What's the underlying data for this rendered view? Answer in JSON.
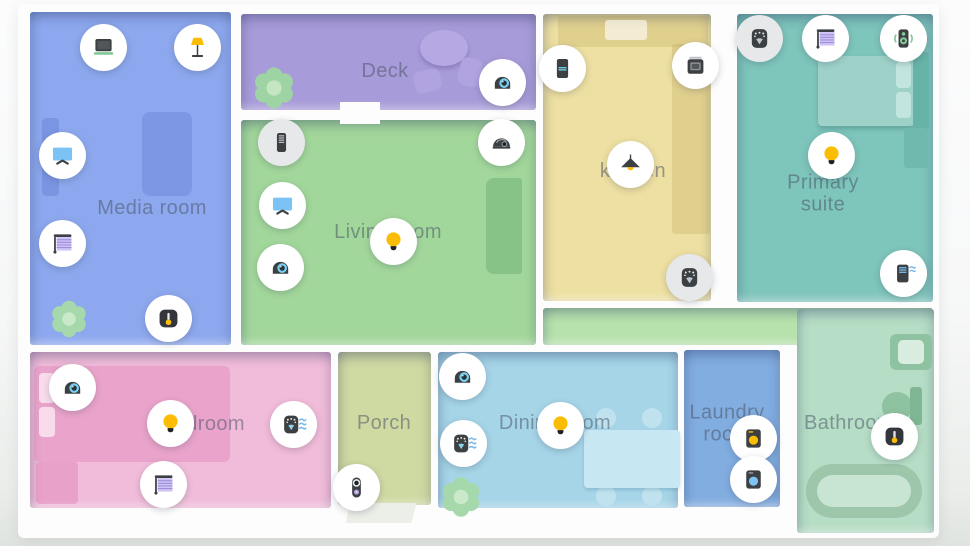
{
  "rooms": [
    {
      "id": "media-room",
      "label": "Media room",
      "color": "#8da8ee",
      "rect": {
        "x": 30,
        "y": 12,
        "w": 201,
        "h": 333
      },
      "label_pos": {
        "x": 152,
        "y": 208
      },
      "wrap": false
    },
    {
      "id": "deck",
      "label": "Deck",
      "color": "#a89bd9",
      "rect": {
        "x": 241,
        "y": 14,
        "w": 295,
        "h": 96
      },
      "label_pos": {
        "x": 385,
        "y": 71
      },
      "wrap": false
    },
    {
      "id": "living-room",
      "label": "Living room",
      "color": "#a2d79b",
      "rect": {
        "x": 241,
        "y": 120,
        "w": 295,
        "h": 225
      },
      "label_pos": {
        "x": 388,
        "y": 232
      },
      "wrap": false
    },
    {
      "id": "kitchen",
      "label": "kitchen",
      "color": "#eee0a2",
      "rect": {
        "x": 543,
        "y": 14,
        "w": 168,
        "h": 287
      },
      "label_pos": {
        "x": 633,
        "y": 171
      },
      "wrap": false
    },
    {
      "id": "primary-suite",
      "label": "Primary suite",
      "color": "#7ec5bb",
      "rect": {
        "x": 737,
        "y": 14,
        "w": 196,
        "h": 288
      },
      "label_pos": {
        "x": 823,
        "y": 194
      },
      "wrap": true
    },
    {
      "id": "hallway",
      "label": "",
      "color": "#b7e2ad",
      "rect": {
        "x": 543,
        "y": 308,
        "w": 390,
        "h": 37
      },
      "label_pos": {
        "x": 0,
        "y": 0
      },
      "wrap": false
    },
    {
      "id": "bedroom",
      "label": "Bedroom",
      "color": "#f1bcd9",
      "rect": {
        "x": 30,
        "y": 352,
        "w": 301,
        "h": 156
      },
      "label_pos": {
        "x": 203,
        "y": 424
      },
      "wrap": false
    },
    {
      "id": "porch",
      "label": "Porch",
      "color": "#cfd9a2",
      "rect": {
        "x": 338,
        "y": 352,
        "w": 93,
        "h": 153
      },
      "label_pos": {
        "x": 384,
        "y": 423
      },
      "wrap": false
    },
    {
      "id": "dining-room",
      "label": "Dining room",
      "color": "#a6d5e8",
      "rect": {
        "x": 438,
        "y": 352,
        "w": 240,
        "h": 156
      },
      "label_pos": {
        "x": 555,
        "y": 423
      },
      "wrap": false
    },
    {
      "id": "laundry-room",
      "label": "Laundry room",
      "color": "#82ade0",
      "rect": {
        "x": 684,
        "y": 350,
        "w": 96,
        "h": 157
      },
      "label_pos": {
        "x": 727,
        "y": 424
      },
      "wrap": true
    },
    {
      "id": "bathroom",
      "label": "Bathroom",
      "color": "#b6ddc5",
      "rect": {
        "x": 797,
        "y": 309,
        "w": 137,
        "h": 224
      },
      "label_pos": {
        "x": 849,
        "y": 423
      },
      "wrap": false
    }
  ],
  "devices": [
    {
      "room": "Media room",
      "icon": "laptop-icon",
      "x": 103,
      "y": 47,
      "muted": false
    },
    {
      "room": "Media room",
      "icon": "floor-lamp-icon",
      "x": 197,
      "y": 47,
      "muted": false
    },
    {
      "room": "Media room",
      "icon": "tv-icon",
      "x": 62,
      "y": 155,
      "muted": false
    },
    {
      "room": "Media room",
      "icon": "blinds-icon",
      "x": 62,
      "y": 243,
      "muted": false
    },
    {
      "room": "Media room",
      "icon": "thermostat-icon",
      "x": 168,
      "y": 318,
      "muted": false
    },
    {
      "room": "Deck",
      "icon": "camera-icon",
      "x": 502,
      "y": 82,
      "muted": false
    },
    {
      "room": "Living room",
      "icon": "speaker-tower-icon",
      "x": 281,
      "y": 142,
      "muted": true
    },
    {
      "room": "Living room",
      "icon": "tv-icon",
      "x": 282,
      "y": 205,
      "muted": false
    },
    {
      "room": "Living room",
      "icon": "camera-icon",
      "x": 280,
      "y": 267,
      "muted": false
    },
    {
      "room": "Living room",
      "icon": "dome-camera-icon",
      "x": 501,
      "y": 142,
      "muted": false
    },
    {
      "room": "Living room",
      "icon": "bulb-icon",
      "x": 393,
      "y": 241,
      "muted": false
    },
    {
      "room": "kitchen",
      "icon": "fridge-icon",
      "x": 562,
      "y": 68,
      "muted": false
    },
    {
      "room": "kitchen",
      "icon": "oven-icon",
      "x": 695,
      "y": 65,
      "muted": false
    },
    {
      "room": "kitchen",
      "icon": "pendant-light-icon",
      "x": 630,
      "y": 164,
      "muted": false
    },
    {
      "room": "kitchen",
      "icon": "smoke-detector-icon",
      "x": 689,
      "y": 277,
      "muted": true
    },
    {
      "room": "Primary suite",
      "icon": "smoke-detector-icon",
      "x": 759,
      "y": 38,
      "muted": true
    },
    {
      "room": "Primary suite",
      "icon": "blinds-icon",
      "x": 825,
      "y": 38,
      "muted": false
    },
    {
      "room": "Primary suite",
      "icon": "speaker-playing-icon",
      "x": 903,
      "y": 38,
      "muted": false
    },
    {
      "room": "Primary suite",
      "icon": "bulb-icon",
      "x": 831,
      "y": 155,
      "muted": false
    },
    {
      "room": "Primary suite",
      "icon": "air-purifier-icon",
      "x": 903,
      "y": 273,
      "muted": false
    },
    {
      "room": "Bedroom",
      "icon": "camera-icon",
      "x": 72,
      "y": 387,
      "muted": false
    },
    {
      "room": "Bedroom",
      "icon": "bulb-icon",
      "x": 170,
      "y": 423,
      "muted": false
    },
    {
      "room": "Bedroom",
      "icon": "blinds-icon",
      "x": 163,
      "y": 484,
      "muted": false
    },
    {
      "room": "Bedroom",
      "icon": "smoke-detector-waves-icon",
      "x": 293,
      "y": 424,
      "muted": false
    },
    {
      "room": "Porch",
      "icon": "doorbell-icon",
      "x": 356,
      "y": 487,
      "muted": false
    },
    {
      "room": "Dining room",
      "icon": "camera-icon",
      "x": 462,
      "y": 376,
      "muted": false
    },
    {
      "room": "Dining room",
      "icon": "smoke-detector-waves-icon",
      "x": 463,
      "y": 443,
      "muted": false
    },
    {
      "room": "Dining room",
      "icon": "bulb-icon",
      "x": 560,
      "y": 425,
      "muted": false
    },
    {
      "room": "Laundry room",
      "icon": "dryer-icon",
      "x": 753,
      "y": 438,
      "muted": false
    },
    {
      "room": "Laundry room",
      "icon": "washer-icon",
      "x": 753,
      "y": 479,
      "muted": false
    },
    {
      "room": "Bathroom",
      "icon": "thermostat-icon",
      "x": 894,
      "y": 436,
      "muted": false
    }
  ]
}
